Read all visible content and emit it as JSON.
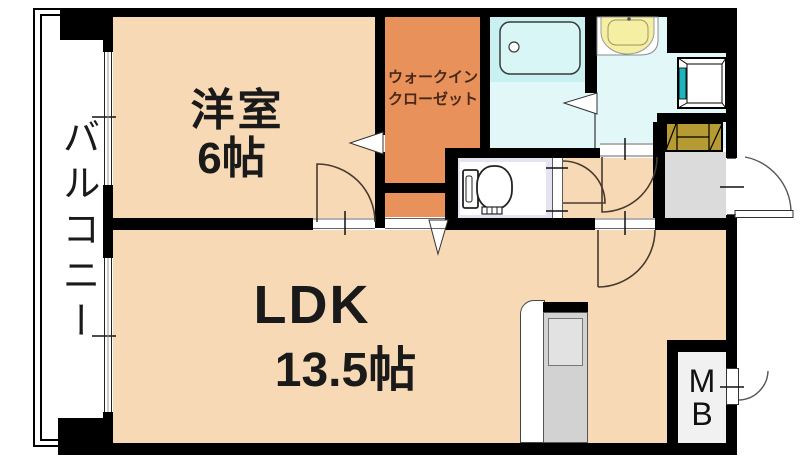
{
  "rooms": {
    "balcony": {
      "label": "バルコニー"
    },
    "western_room": {
      "label": "洋室",
      "size": "6帖"
    },
    "walk_in_closet": {
      "label_line1": "ウォークイン",
      "label_line2": "クローゼット"
    },
    "ldk": {
      "label": "LDK",
      "size": "13.5帖"
    },
    "meter_box": {
      "label_line1": "M",
      "label_line2": "B"
    }
  },
  "fixtures": {
    "bathtub": "bathtub-icon",
    "washbasin": "washbasin-icon",
    "washing_machine_pan": "washing-machine-pan-icon",
    "toilet": "toilet-icon",
    "shoe_cabinet": "shoe-cabinet-icon",
    "kitchen_counter": "kitchen-counter-icon"
  },
  "colors": {
    "room_peach": "#F7DAB5",
    "closet_orange": "#E8915A",
    "bath_cyan": "#C9F1F1",
    "wet_area_pale_cyan": "#E2F7F8",
    "toilet_lavender": "#E3E3F1",
    "entry_gray": "#DBDBDB",
    "shoe_cabinet_ochre": "#B69A33",
    "washbasin_yellow": "#F5EFA3",
    "faucet_teal": "#1CB5BE",
    "wall_black": "#000000"
  }
}
